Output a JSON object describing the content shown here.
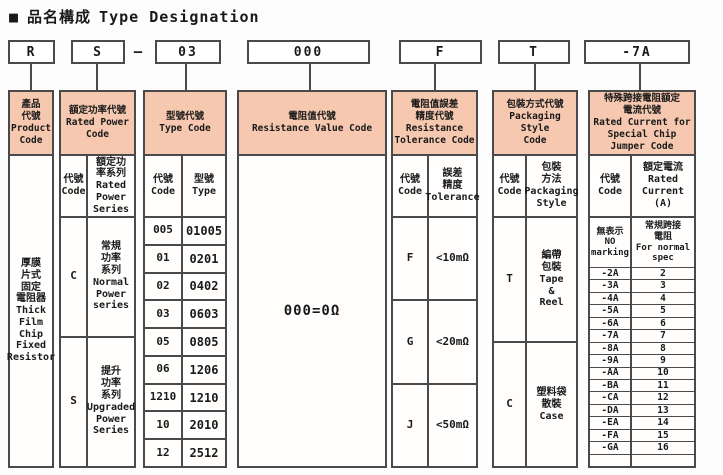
{
  "title": {
    "marker": "■",
    "cjk": "品名構成",
    "en": "Type Designation"
  },
  "colors": {
    "header_bg": "#f5c8af",
    "border": "#4a4a4a",
    "background": "#fdfdfd"
  },
  "code_boxes": {
    "product": "R",
    "power": "S",
    "dash": "–",
    "type": "03",
    "resistance": "000",
    "tolerance": "F",
    "packaging": "T",
    "current": "-7A"
  },
  "product": {
    "header": "產品\n代號\nProduct\nCode",
    "body": "厚膜\n片式\n固定\n電阻器\nThick\nFilm\nChip\nFixed\nResistor"
  },
  "power": {
    "header": "額定功率代號\nRated Power\nCode",
    "sub_code": "代號\nCode",
    "sub_series": "額定功\n率系列\nRated\nPower\nSeries",
    "rows": [
      {
        "code": "C",
        "series": "常規\n功率\n系列\nNormal\nPower\nseries"
      },
      {
        "code": "S",
        "series": "提升\n功率\n系列\nUpgraded\nPower\nSeries"
      }
    ]
  },
  "type": {
    "header": "型號代號\nType Code",
    "sub_code": "代號\nCode",
    "sub_type": "型號\nType",
    "rows": [
      {
        "code": "005",
        "type": "01005"
      },
      {
        "code": "01",
        "type": "0201"
      },
      {
        "code": "02",
        "type": "0402"
      },
      {
        "code": "03",
        "type": "0603"
      },
      {
        "code": "05",
        "type": "0805"
      },
      {
        "code": "06",
        "type": "1206"
      },
      {
        "code": "1210",
        "type": "1210"
      },
      {
        "code": "10",
        "type": "2010"
      },
      {
        "code": "12",
        "type": "2512"
      }
    ]
  },
  "resistance": {
    "header": "電阻值代號\nResistance Value Code",
    "body": "000=0Ω"
  },
  "tolerance": {
    "header": "電阻值誤差\n精度代號\nResistance\nTolerance Code",
    "sub_code": "代號\nCode",
    "sub_tolerance": "誤差\n精度\nTolerance",
    "rows": [
      {
        "code": "F",
        "tolerance": "<10mΩ"
      },
      {
        "code": "G",
        "tolerance": "<20mΩ"
      },
      {
        "code": "J",
        "tolerance": "<50mΩ"
      }
    ]
  },
  "packaging": {
    "header": "包裝方式代號\nPackaging Style\nCode",
    "sub_code": "代號\nCode",
    "sub_style": "包裝\n方法\nPackaging\nStyle",
    "rows": [
      {
        "code": "T",
        "style": "編帶\n包裝\nTape\n&\nReel"
      },
      {
        "code": "C",
        "style": "塑料袋\n散裝\nCase"
      }
    ]
  },
  "current": {
    "header": "特殊跨接電阻額定\n電流代號\nRated Current for\nSpecial Chip\nJumper Code",
    "sub_code": "代號\nCode",
    "sub_current": "額定電流\nRated\nCurrent\n(A)",
    "special": {
      "code": "無表示\nNO\nmarking",
      "value": "常規跨接\n電阻\nFor normal\nspec"
    },
    "rows": [
      {
        "code": "-2A",
        "value": "2"
      },
      {
        "code": "-3A",
        "value": "3"
      },
      {
        "code": "-4A",
        "value": "4"
      },
      {
        "code": "-5A",
        "value": "5"
      },
      {
        "code": "-6A",
        "value": "6"
      },
      {
        "code": "-7A",
        "value": "7"
      },
      {
        "code": "-8A",
        "value": "8"
      },
      {
        "code": "-9A",
        "value": "9"
      },
      {
        "code": "-AA",
        "value": "10"
      },
      {
        "code": "-BA",
        "value": "11"
      },
      {
        "code": "-CA",
        "value": "12"
      },
      {
        "code": "-DA",
        "value": "13"
      },
      {
        "code": "-EA",
        "value": "14"
      },
      {
        "code": "-FA",
        "value": "15"
      },
      {
        "code": "-GA",
        "value": "16"
      }
    ]
  }
}
